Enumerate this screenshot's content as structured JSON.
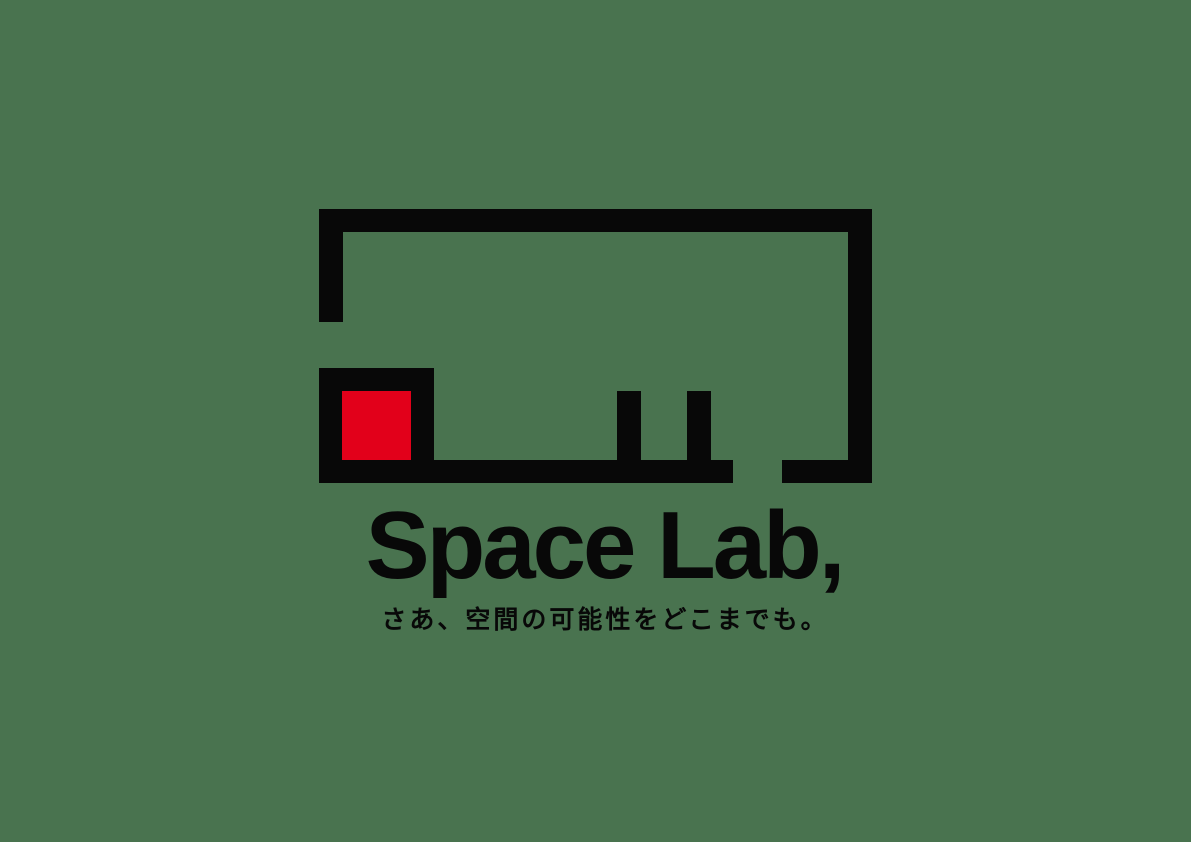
{
  "brand": {
    "wordmark": "Space Lab,",
    "tagline": "さあ、空間の可能性をどこまでも。"
  },
  "logo_mark": {
    "icon": "floor-plan-frame-icon",
    "accent_square": "red-square"
  },
  "colors": {
    "background": "#49734F",
    "ink": "#080808",
    "accent_red": "#E2001A"
  }
}
